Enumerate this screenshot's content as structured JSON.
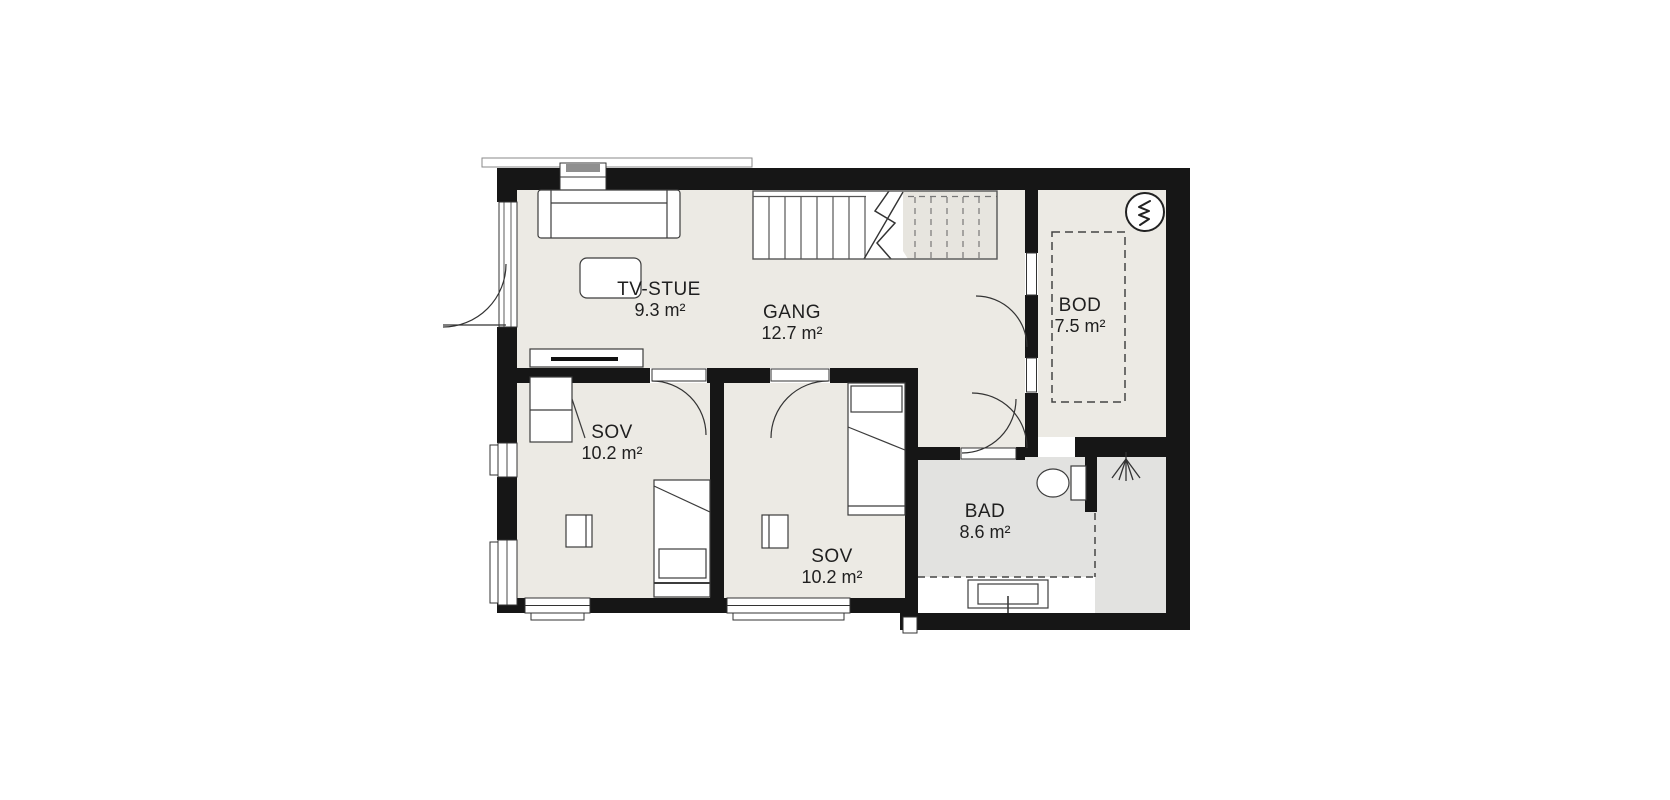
{
  "plan": {
    "type": "floor-plan",
    "rooms": [
      {
        "key": "tv_stue",
        "name": "TV-STUE",
        "area": "9.3 m²"
      },
      {
        "key": "gang",
        "name": "GANG",
        "area": "12.7 m²"
      },
      {
        "key": "bod",
        "name": "BOD",
        "area": "7.5 m²"
      },
      {
        "key": "sov1",
        "name": "SOV",
        "area": "10.2 m²"
      },
      {
        "key": "sov2",
        "name": "SOV",
        "area": "10.2 m²"
      },
      {
        "key": "bad",
        "name": "BAD",
        "area": "8.6 m²"
      }
    ],
    "symbols": [
      "stairs",
      "water-heater",
      "shower-head",
      "toilet",
      "washbasin",
      "sofa",
      "coffee-table",
      "tv-bench",
      "bed",
      "nightstand",
      "wardrobe"
    ],
    "colors": {
      "wall": "#161616",
      "floor": "#ECEAE4",
      "floor_wet": "#E2E2E0",
      "stair_shaded": "#E7E5DF",
      "line": "#3c3c3c",
      "background": "#ffffff"
    }
  }
}
